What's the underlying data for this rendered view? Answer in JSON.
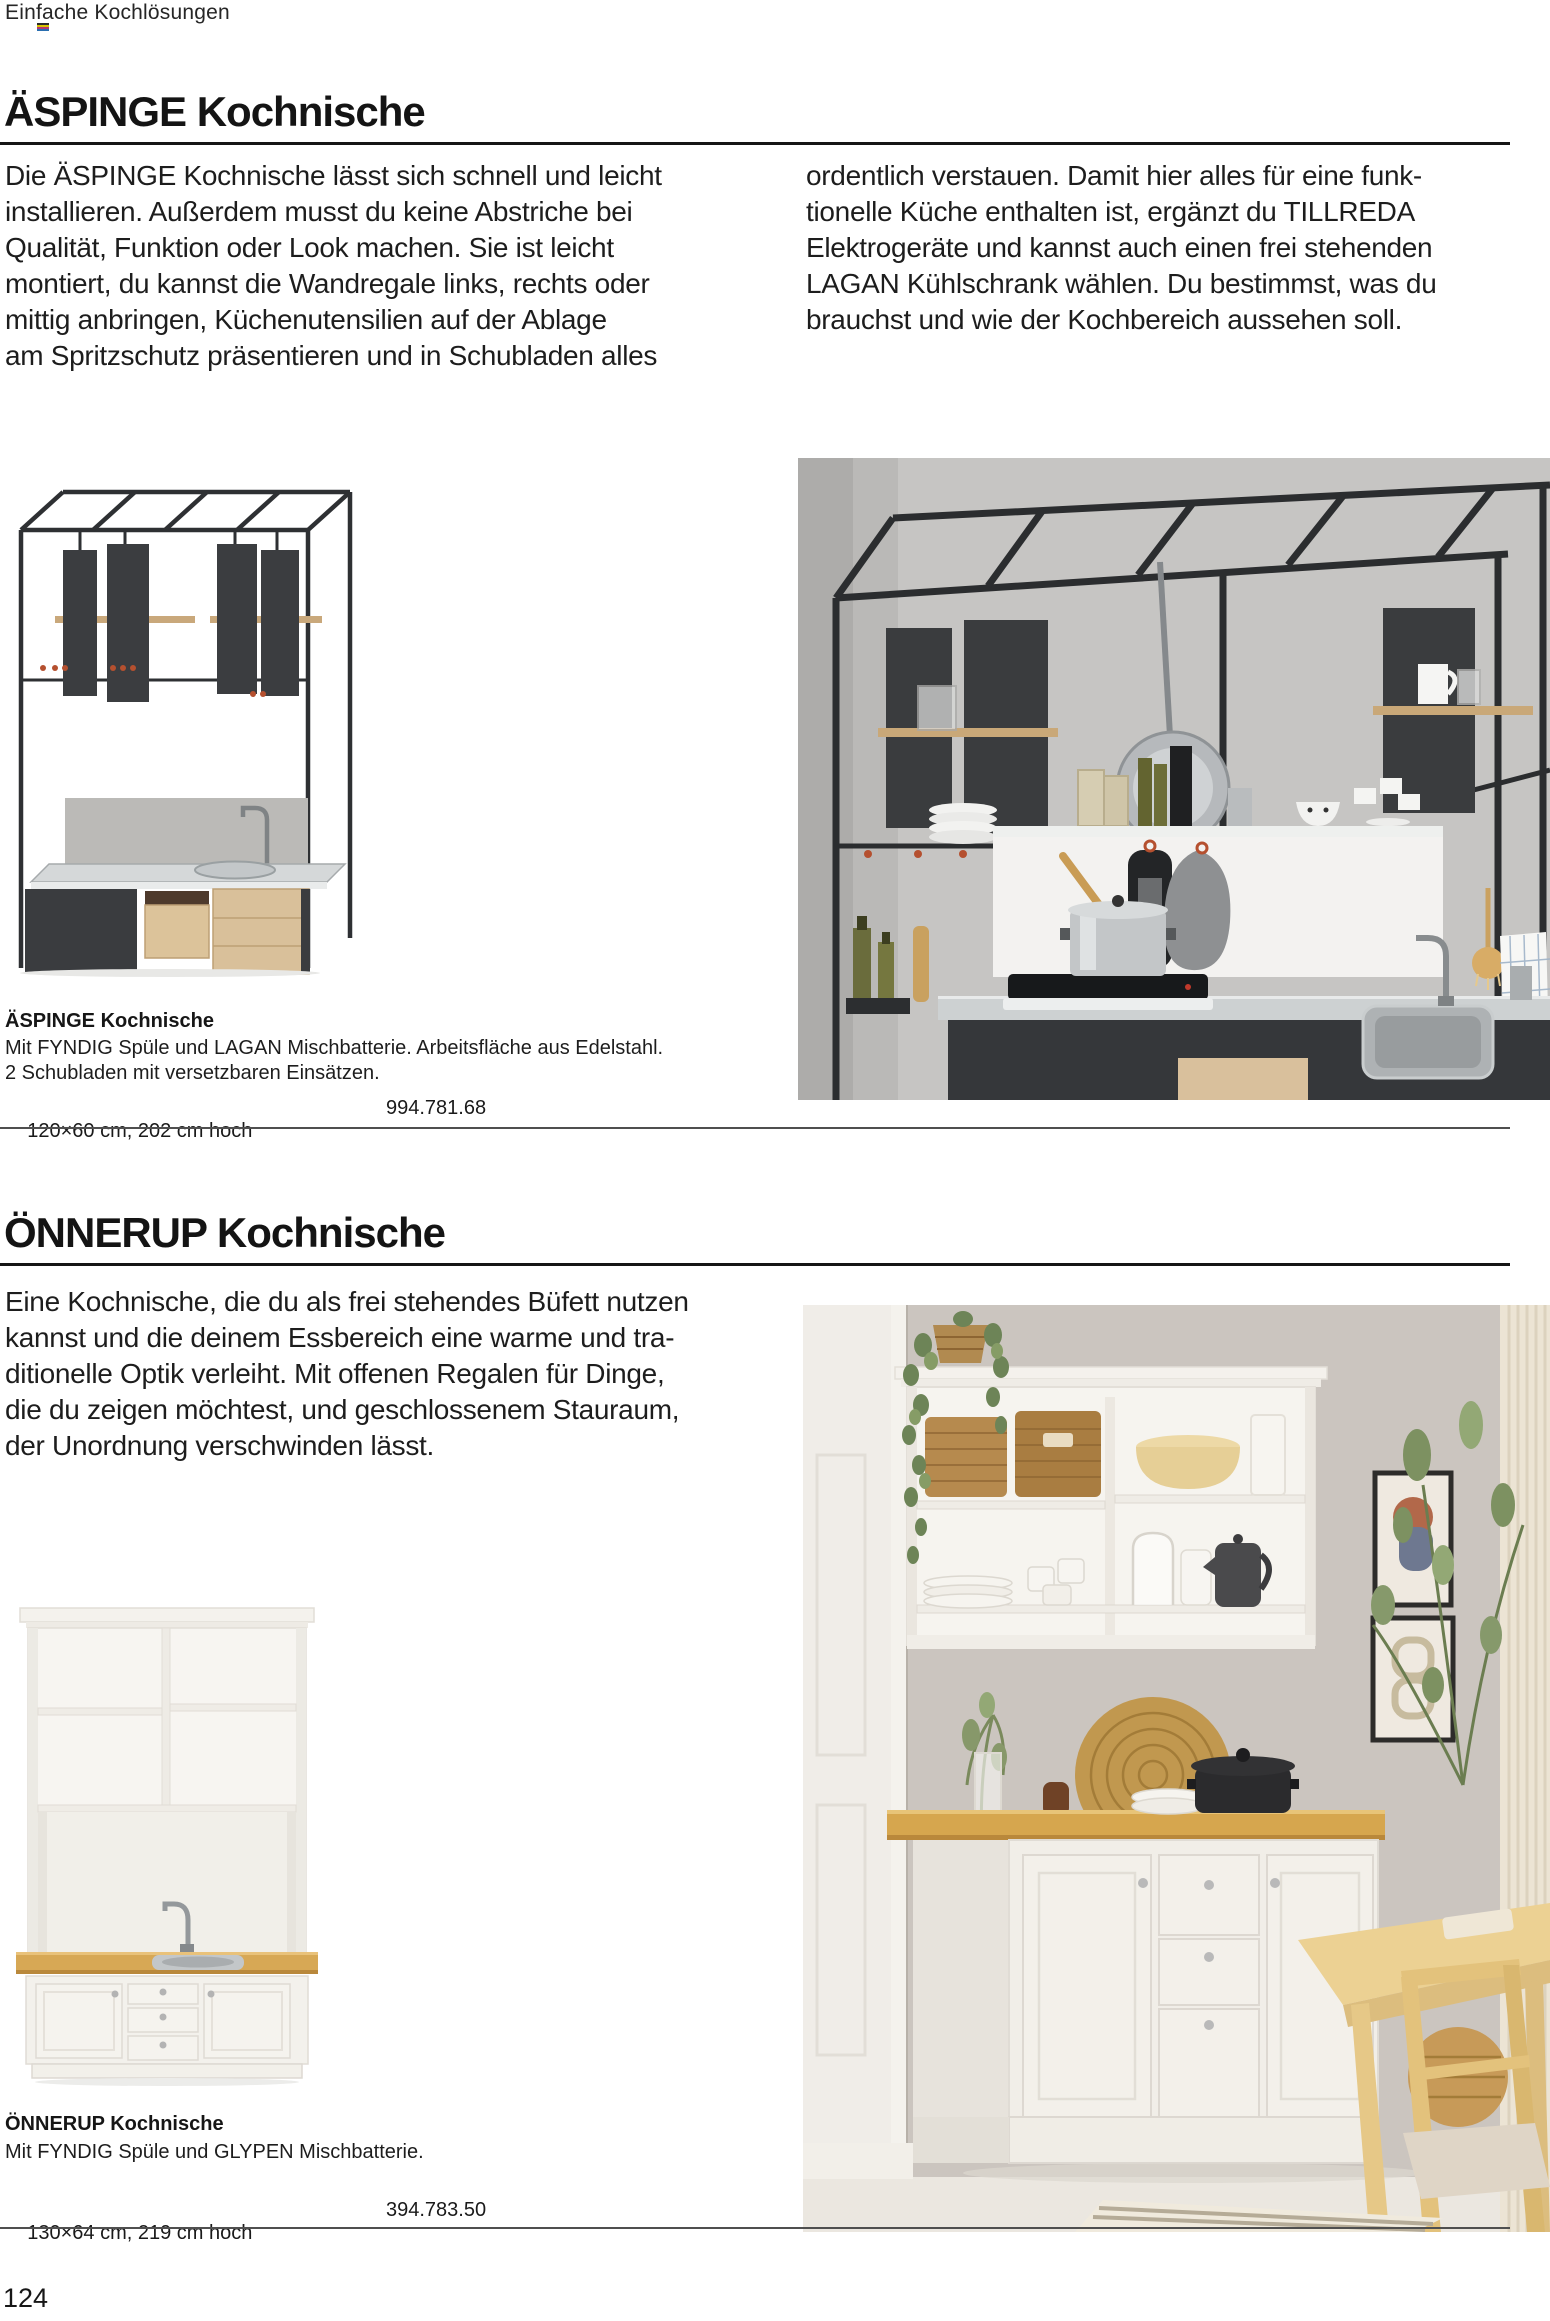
{
  "page": {
    "eyebrow": "Einfache Kochlösungen",
    "page_number": "124"
  },
  "section_aspinge": {
    "heading": "ÄSPINGE Kochnische",
    "intro_col1": "Die ÄSPINGE Kochnische lässt sich schnell und leicht\ninstallieren. Außerdem musst du keine Abstriche bei\nQualität, Funktion oder Look machen. Sie ist leicht\nmontiert, du kannst die Wandregale links, rechts oder\nmittig anbringen, Küchenutensilien auf der Ablage\nam Spritzschutz präsentieren und in Schubladen alles",
    "intro_col2": "ordentlich verstauen. Damit hier alles für eine funk-\ntionelle Küche enthalten ist, ergänzt du TILLREDA\nElektrogeräte und kannst auch einen frei stehenden\nLAGAN Kühlschrank wählen. Du bestimmst, was du\nbrauchst und wie der Kochbereich aussehen soll.",
    "product": {
      "name": "ÄSPINGE Kochnische",
      "description": "Mit FYNDIG Spüle und LAGAN Mischbatterie. Arbeitsfläche aus Edelstahl.\n2 Schubladen mit versetzbaren Einsätzen.",
      "dimensions": "120×60 cm, 202 cm hoch",
      "article_number": "994.781.68"
    }
  },
  "section_onnerup": {
    "heading": "ÖNNERUP Kochnische",
    "intro": "Eine Kochnische, die du als frei stehendes Büfett nutzen\nkannst und die deinem Essbereich eine warme und tra-\nditionelle Optik verleiht. Mit offenen Regalen für Dinge,\ndie du zeigen möchtest, und geschlossenem Stauraum,\nder Unordnung verschwinden lässt.",
    "product": {
      "name": "ÖNNERUP Kochnische",
      "description": "Mit FYNDIG Spüle und GLYPEN Mischbatterie.",
      "dimensions": "130×64 cm, 219 cm hoch",
      "article_number": "394.783.50"
    }
  },
  "images": {
    "aspinge_product_alt": "ÄSPINGE Kochnische Produktbild: schwarzes Stahlgestell mit Wandregalen, Edelstahl-Arbeitsfläche, Spüle und Schubladen",
    "aspinge_room_alt": "ÄSPINGE Kochnische im Raum: graue Wand, hängende Schränke, Töpfe, Kochfeld und Spüle",
    "onnerup_product_alt": "ÖNNERUP Kochnische Produktbild: weißes Büfett mit offenen Regalen, Holzarbeitsplatte und Spüle",
    "onnerup_room_alt": "ÖNNERUP Kochnische im Essbereich mit Körben, Geschirr, Bildern und Esstisch"
  },
  "colors": {
    "rule_dark": "#161616",
    "rule_light": "#4f4f4f",
    "hook_red": "#b5502f",
    "panel_dark": "#3a3c3f",
    "wood_oak": "#d7a855",
    "steel": "#cfd2d3",
    "wall_grey": "#c6c5c3",
    "wall_taupe": "#cbc5bf",
    "cream_white": "#f3f1ec"
  }
}
